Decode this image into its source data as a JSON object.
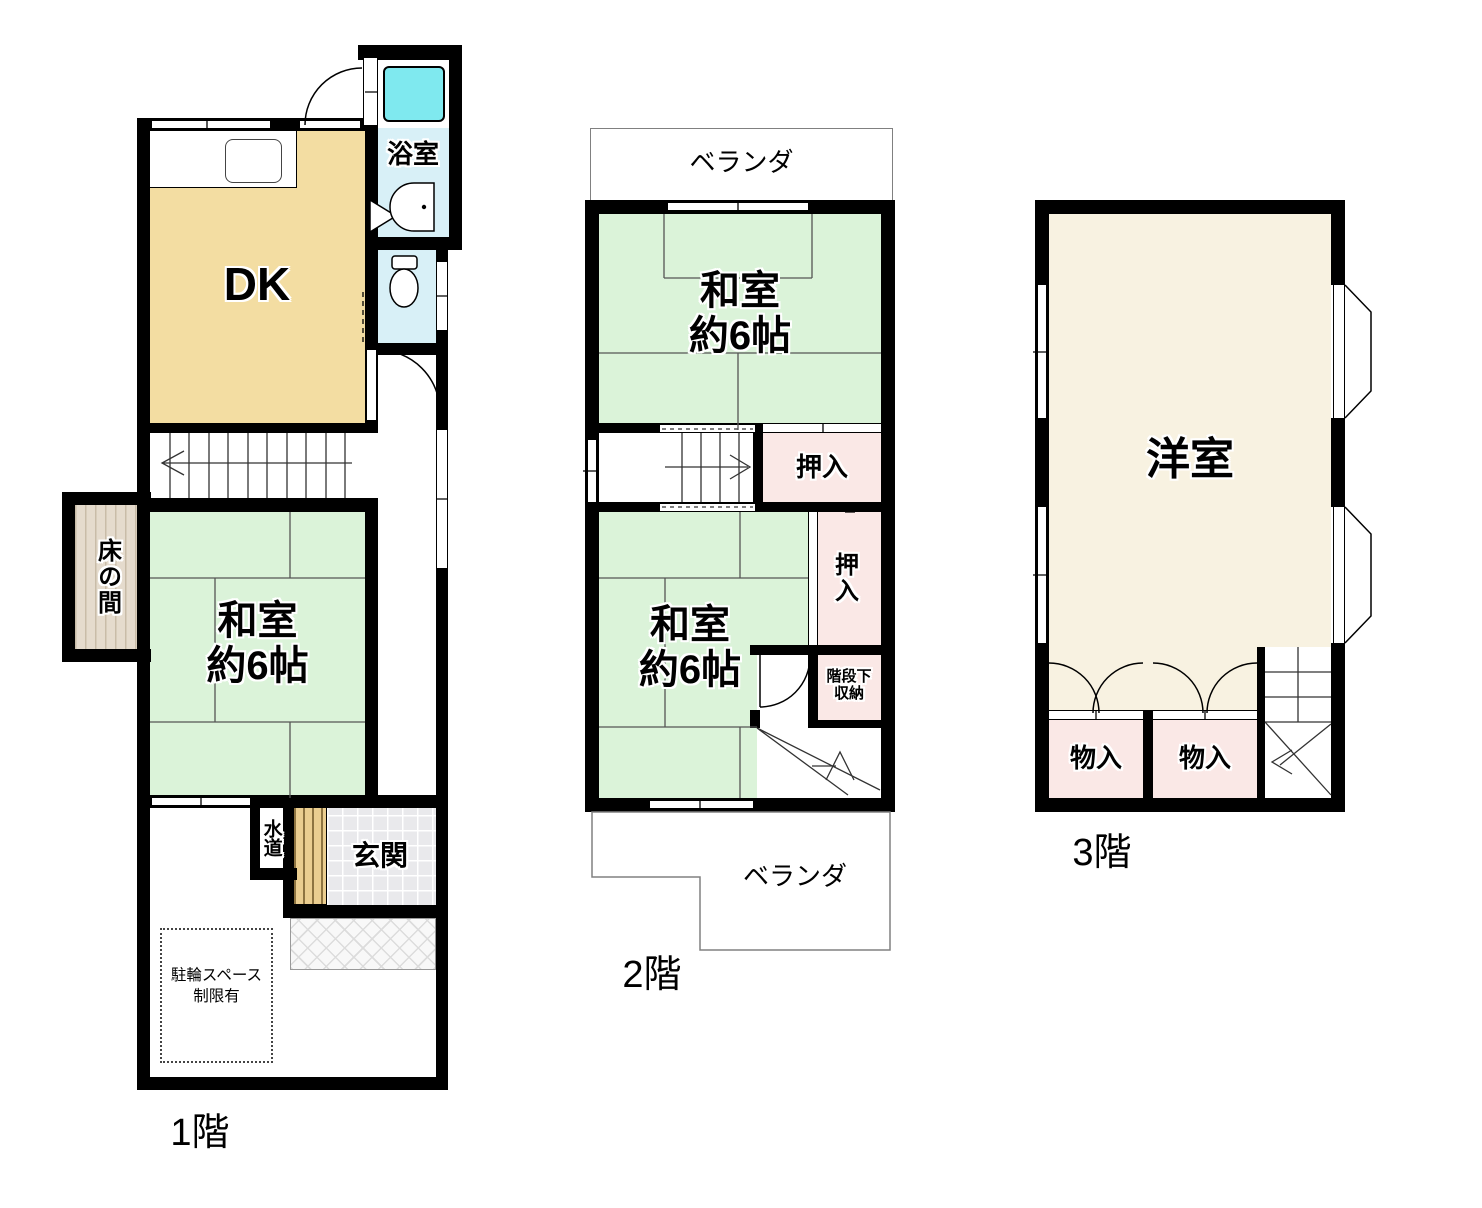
{
  "colors": {
    "wall": "#000000",
    "tatami_green": "#dbf3d9",
    "dk_tan": "#f3dda2",
    "closet_pink": "#fae8e6",
    "water_blue": "#d8f0f7",
    "bathtub_cyan": "#7fe9ef",
    "western_cream": "#f8f2e1",
    "tokonoma_beige": "#e5dbcd",
    "genkan_gray": "#e9e9ec",
    "wood_tan": "#ebce90"
  },
  "floors": [
    {
      "label": "1階",
      "rooms": {
        "dk": "DK",
        "bath": "浴室",
        "tokonoma": "床の間",
        "washitsu_l1": "和室",
        "washitsu_l2": "約6帖",
        "suido": "水道",
        "genkan": "玄関",
        "bicycle_l1": "駐輪スペース",
        "bicycle_l2": "制限有"
      }
    },
    {
      "label": "2階",
      "rooms": {
        "veranda_top": "ベランダ",
        "washitsu_n_l1": "和室",
        "washitsu_n_l2": "約6帖",
        "oshiire_a": "押入",
        "oshiire_b": "押入",
        "kaidanshita_l1": "階段下",
        "kaidanshita_l2": "収納",
        "washitsu_s_l1": "和室",
        "washitsu_s_l2": "約6帖",
        "veranda_bottom": "ベランダ"
      }
    },
    {
      "label": "3階",
      "rooms": {
        "yoshitsu": "洋室",
        "monoire_a": "物入",
        "monoire_b": "物入"
      }
    }
  ]
}
